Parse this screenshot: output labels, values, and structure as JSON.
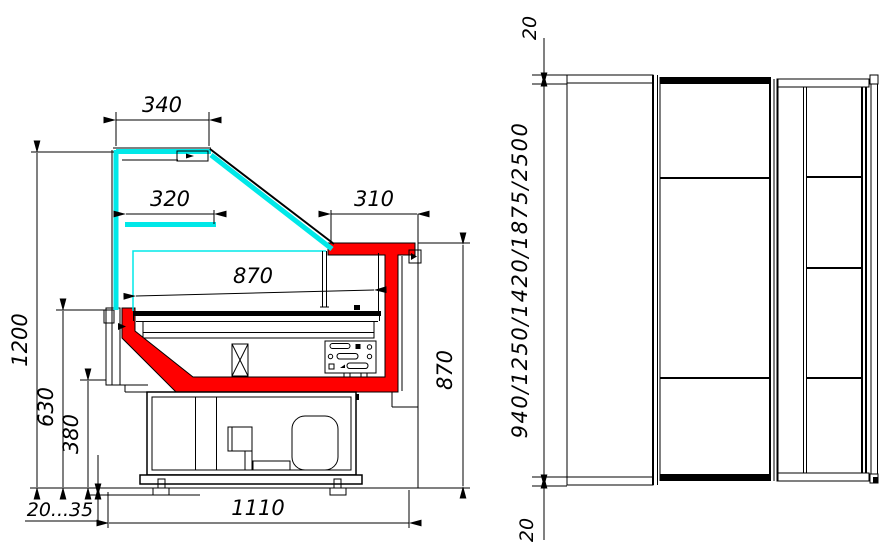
{
  "drawing": {
    "title": "refrigerated-display-counter-dimension-drawing",
    "colors": {
      "glass": "#00e8e8",
      "liner": "#ff0000",
      "line": "#000000",
      "background": "#ffffff"
    },
    "side_view": {
      "d_canopy_depth": "340",
      "d_shelf_depth": "320",
      "d_worktop_depth": "310",
      "d_deck_width": "870",
      "d_total_height": "1200",
      "d_front_panel_height": "630",
      "d_base_height": "380",
      "d_feet_adjust": "20...35",
      "d_base_depth": "1110",
      "d_worktop_height": "870"
    },
    "plan_view": {
      "d_side_panel_top": "20",
      "d_length_options": "940/1250/1420/1875/2500",
      "d_side_panel_bottom": "20"
    }
  }
}
